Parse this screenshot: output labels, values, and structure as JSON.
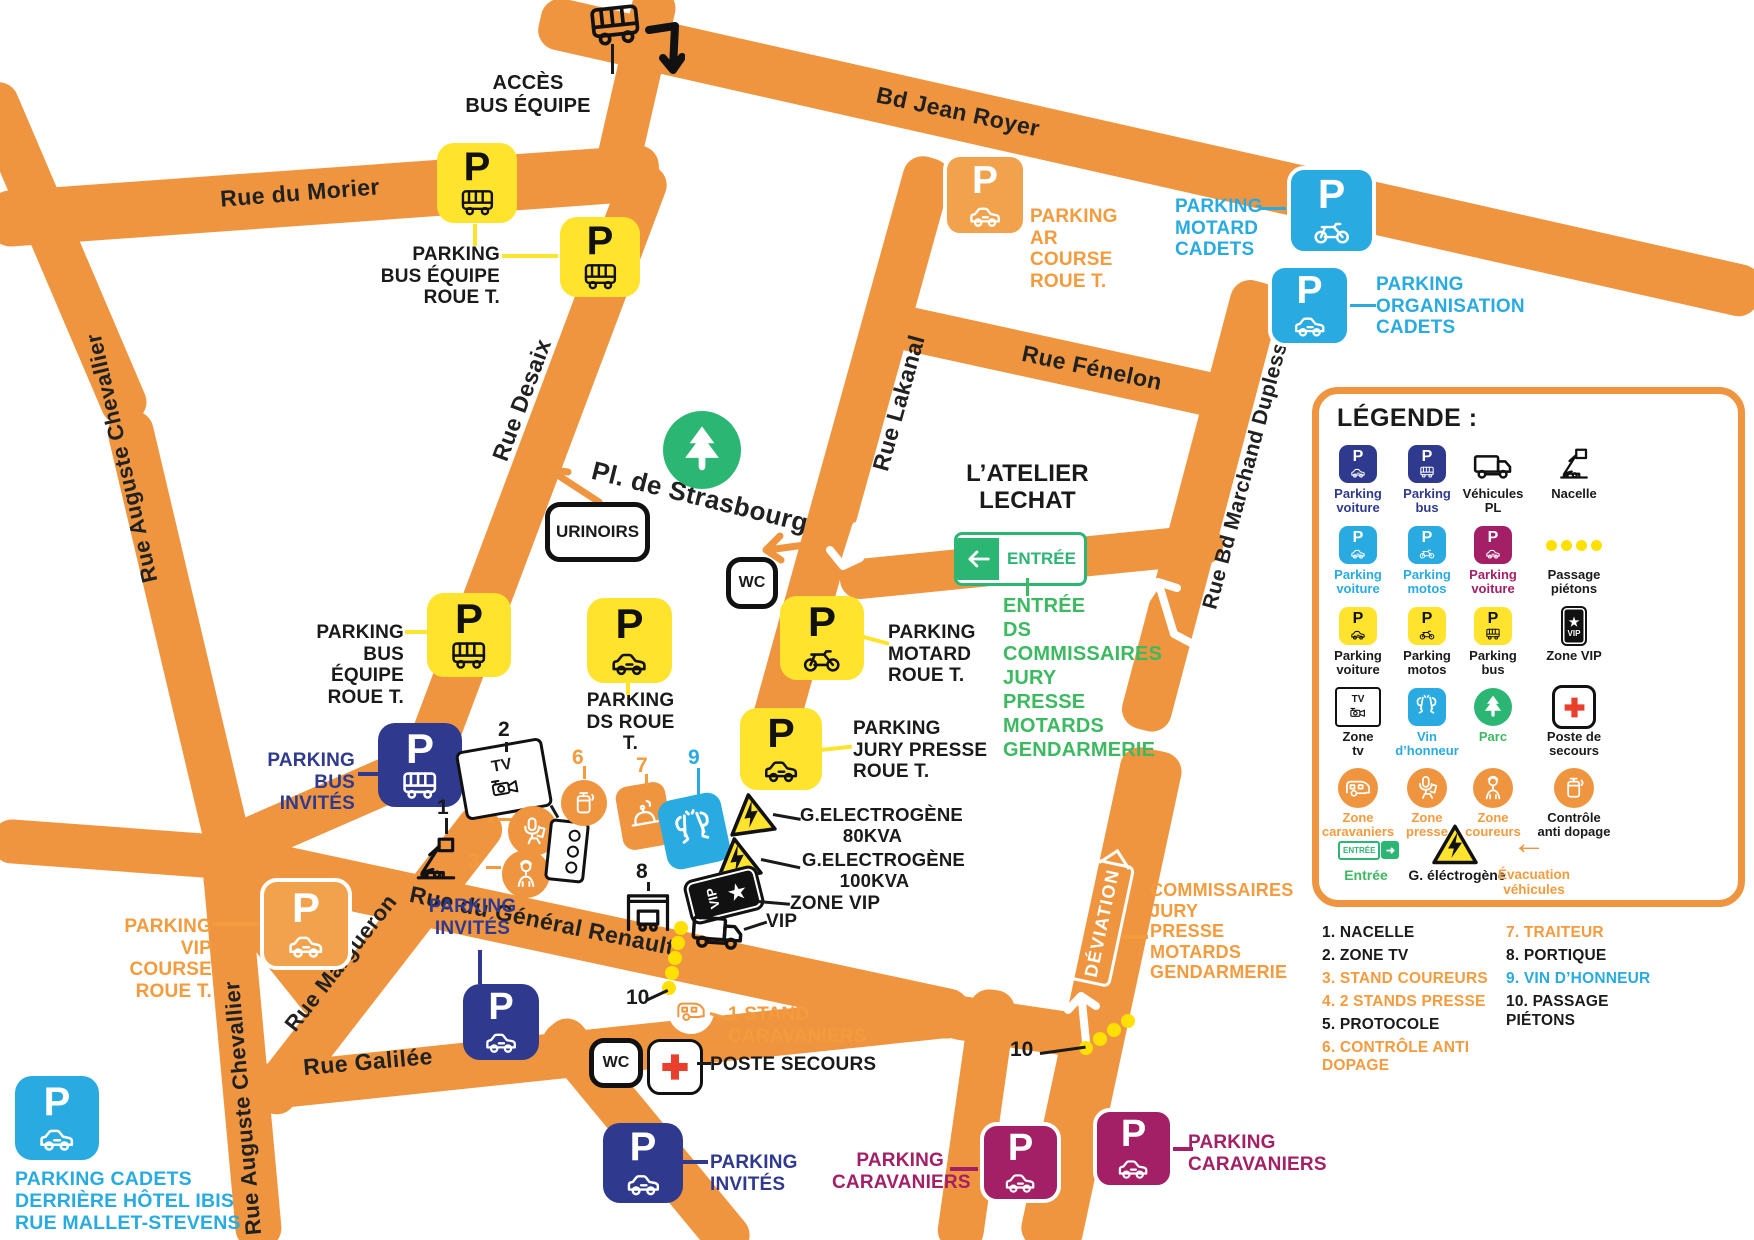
{
  "palette": {
    "road": "#F0953F",
    "yellow": "#FFE32C",
    "navy": "#2F3A8F",
    "cyan": "#29ABE2",
    "magenta": "#A32066",
    "green": "#2BB673",
    "green_text": "#3DBA61",
    "red": "#E8402D",
    "orange_text": "#F49B3E",
    "dot_yellow": "#FFE000",
    "black": "#1A1A1A"
  },
  "p": "P",
  "streets": {
    "bd_jean_royer": "Bd Jean Royer",
    "rue_du_morier": "Rue du Morier",
    "rue_desaix": "Rue Desaix",
    "rue_auguste_chevallier_top": "Rue Auguste Chevallier",
    "rue_auguste_chevallier_bottom": "Rue Auguste Chevallier",
    "rue_margueron": "Rue Margueron",
    "rue_galilee": "Rue Galilée",
    "rue_lakanal": "Rue Lakanal",
    "rue_fenelon": "Rue Fénelon",
    "rue_marchand_duplessis": "Rue Bd Marchand Duplessis",
    "rue_general_renault": "Rue du Général Renault",
    "pl_strasbourg": "Pl. de Strasbourg",
    "deviation": "DÉVIATION"
  },
  "labels": {
    "acces_bus": "ACCÈS\nBUS ÉQUIPE",
    "parking_bus_equipe": "PARKING\nBUS ÉQUIPE\nROUE T.",
    "parking_ds": "PARKING\nDS ROUE T.",
    "parking_motard_roue": "PARKING\nMOTARD\nROUE T.",
    "parking_jury": "PARKING\nJURY PRESSE\nROUE T.",
    "parking_bus_invites": "PARKING\nBUS INVITÉS",
    "parking_invites": "PARKING\nINVITÉS",
    "parking_vip_course": "PARKING\nVIP COURSE\nROUE T.",
    "parking_ar_course": "PARKING\nAR\nCOURSE\nROUE T.",
    "parking_motard_cadets": "PARKING\nMOTARD\nCADETS",
    "parking_org_cadets": "PARKING\nORGANISATION\nCADETS",
    "parking_caravaniers": "PARKING\nCARAVANIERS",
    "parking_cadets_ibis": "PARKING CADETS\nDERRIÈRE HÔTEL IBIS\nRUE MALLET-STEVENS",
    "urinoirs": "URINOIRS",
    "wc": "WC",
    "atelier": "L’ATELIER\nLECHAT",
    "entree": "ENTRÉE",
    "entree_block": "ENTRÉE\nDS\nCOMMISSAIRES\nJURY\nPRESSE\nMOTARDS\nGENDARMERIE",
    "commissaires_block": "COMMISSAIRES\nJURY\nPRESSE\nMOTARDS\nGENDARMERIE",
    "g80": "G.ELECTROGÈNE\n80KVA",
    "g100": "G.ELECTROGÈNE\n100KVA",
    "zone_vip": "ZONE VIP",
    "vip": "VIP",
    "stand_caravaniers": "1 STAND\nCARAVANIERS",
    "poste_secours": "POSTE SECOURS",
    "tv": "TV",
    "vip_icon": "VIP"
  },
  "markers": {
    "m1": "1",
    "m2": "2",
    "m3": "3",
    "m4": "4",
    "m5": "5",
    "m6": "6",
    "m7": "7",
    "m8": "8",
    "m9": "9",
    "m10": "10"
  },
  "legend": {
    "title": "LÉGENDE :",
    "items": [
      "Parking\nvoiture",
      "Parking\nbus",
      "Véhicules PL",
      "Nacelle",
      "Parking\nvoiture",
      "Parking\nmotos",
      "Parking\nvoiture",
      "Passage\npiétons",
      "Parking\nvoiture",
      "Parking\nmotos",
      "Parking\nbus",
      "Zone VIP",
      "Zone\ntv",
      "Vin\nd’honneur",
      "Parc",
      "Poste de\nsecours",
      "Zone\ncaravaniers",
      "Zone\npresse",
      "Zone\ncoureurs",
      "Contrôle\nanti dopage",
      "Entrée",
      "G. éléctrogène",
      "Évacuation\nvéhicules"
    ]
  },
  "list": {
    "left": [
      "1. NACELLE",
      "2. ZONE TV",
      "3. STAND COUREURS",
      "4. 2 STANDS PRESSE",
      "5. PROTOCOLE",
      "6. CONTRÔLE ANTI DOPAGE"
    ],
    "right": [
      "7. TRAITEUR",
      "8. PORTIQUE",
      "9. VIN D’HONNEUR",
      "10. PASSAGE PIÉTONS"
    ]
  }
}
